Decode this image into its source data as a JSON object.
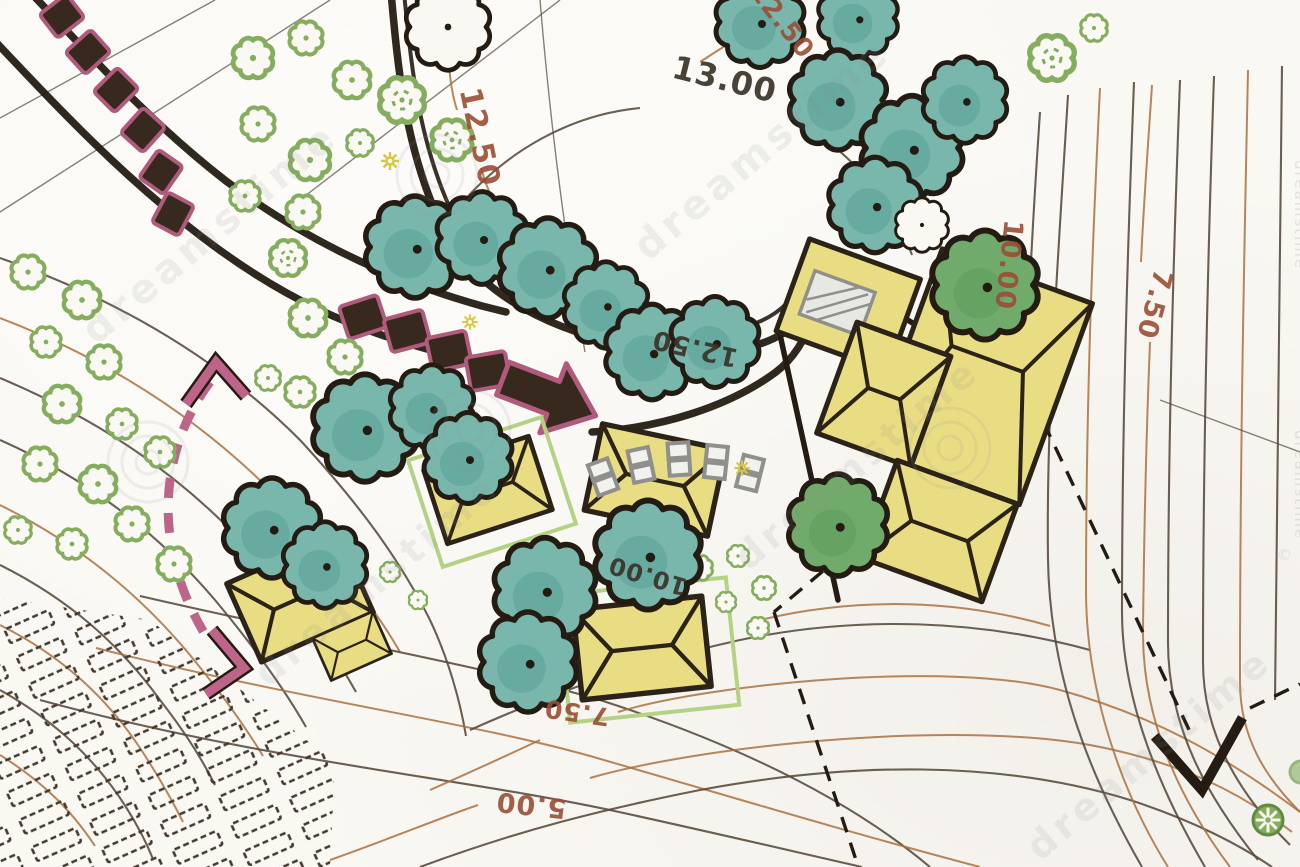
{
  "map": {
    "type": "landscape-architecture-site-plan",
    "labels": {
      "contour_13_00": "13.00",
      "contour_12_50_left": "12.50",
      "contour_12_50_top": "12.50",
      "contour_12_50_mid": "12.50",
      "contour_10_00_right": "10.00",
      "contour_10_00_mid": "10.00",
      "contour_7_50_right": "7.50",
      "contour_7_50_bottom": "7.50",
      "contour_5_00_bottom": "5.00"
    },
    "watermark": {
      "brand": "dreamstime",
      "copyright": "©"
    },
    "symbols": {
      "teal-tree": "round canopy tree, blue-green crayon",
      "green-tree": "round canopy tree, green crayon",
      "shrub": "scalloped shrub outline with center dot",
      "building": "yellow hip-roof building footprint",
      "paver": "dark walkway paver with magenta outline",
      "walkway-arrow": "large block arrow on path",
      "circulation-arrow": "pink dashed double-headed arrow",
      "sight-line": "black dashed line with V arrowhead",
      "terrace-rows": "dashed rectangles, planting beds",
      "parking-stall": "gray double-square seat/stall"
    },
    "colors": {
      "paper": "#faf8f3",
      "ink": "#241c12",
      "teal_fill": "#79b7ad",
      "teal_dark": "#48978c",
      "green_fill": "#71ab6b",
      "shrub_green": "#84ae5d",
      "building_fill": "#e9dd84",
      "building_stroke": "#2b2317",
      "plot_green": "#b3d284",
      "paver_fill": "#38291e",
      "paver_outline": "#b05a7c",
      "pink": "#bf6489",
      "contour_sepia": "#aa713f",
      "contour_dark": "#55493c",
      "label_brown": "#9a4e35",
      "label_dark": "#3a332a",
      "gray_stall": "#8f8f8b",
      "star_yellow": "#d8c741"
    }
  }
}
